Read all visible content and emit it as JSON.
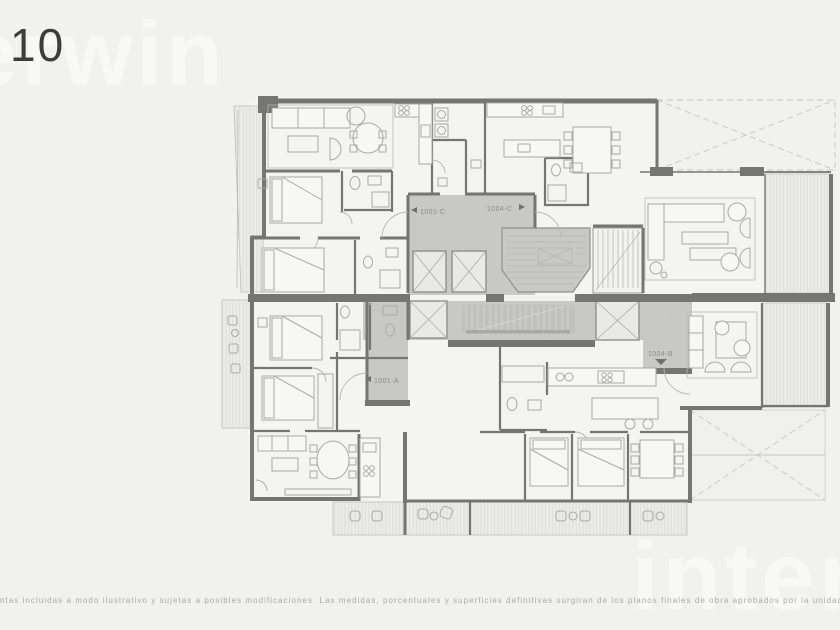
{
  "page": {
    "floor_number": "10",
    "brand": "interwin",
    "watermarks": {
      "top_left": "erwin",
      "bottom_right": "interw"
    },
    "disclaimer": "ntas incluidas a modo ilustrativo y sujetas a posibles modificaciones. Las medidas, porcentuales y superficies definitivas surgiran de los planos finales de obra aprobados por la unidad compete"
  },
  "floor_plan": {
    "type": "architectural-floor-plan",
    "floor": "10",
    "units": [
      {
        "id": "1001-C",
        "label": "1001-C",
        "arrow": "left"
      },
      {
        "id": "1004-C",
        "label": "1004-C",
        "arrow": "right"
      },
      {
        "id": "1001-A",
        "label": "1001-A",
        "arrow": "left"
      },
      {
        "id": "1004-B",
        "label": "1004-B",
        "arrow": "down"
      }
    ],
    "colors": {
      "background": "#f1f1ef",
      "wall": "#757572",
      "corridor": "#c8c8c5",
      "room": "#f4f4f1",
      "furniture": "#a9a9a6",
      "deck": "#ebebe8",
      "label": "#8b8b88"
    }
  }
}
